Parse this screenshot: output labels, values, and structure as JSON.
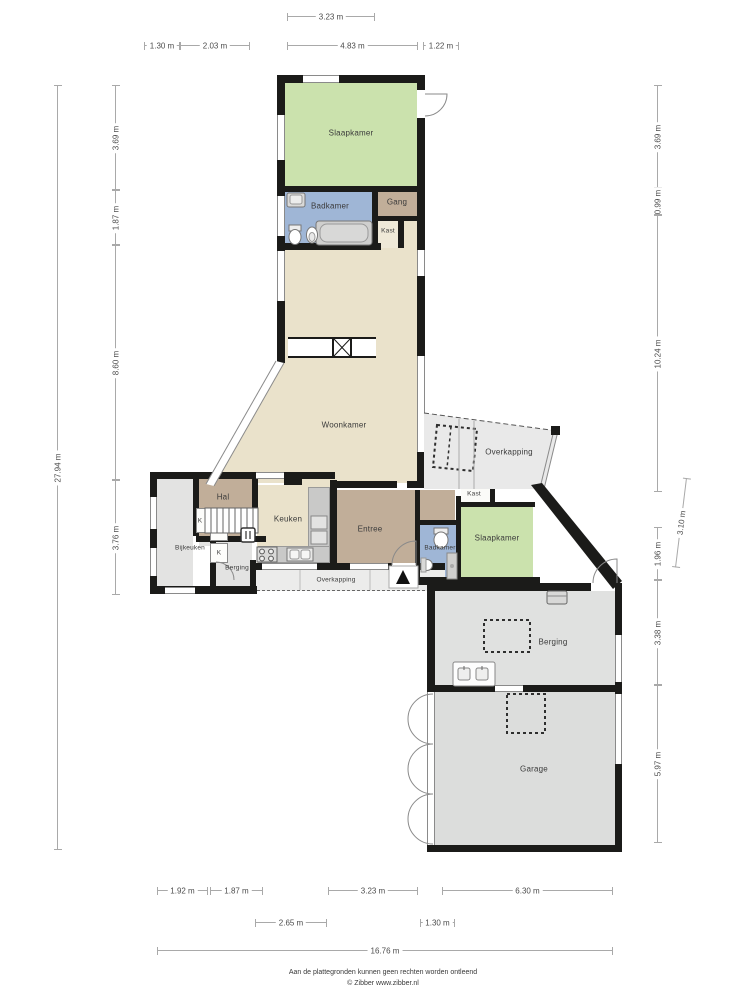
{
  "rooms": {
    "slaapkamer_top": "Slaapkamer",
    "badkamer_top": "Badkamer",
    "gang": "Gang",
    "kast_top": "Kast",
    "woonkamer": "Woonkamer",
    "overkapping_right": "Overkapping",
    "hal": "Hal",
    "keuken": "Keuken",
    "bijkeuken": "Bijkeuken",
    "berging_left": "Berging",
    "kast_k_stairs": "K",
    "kast_k_berging": "K",
    "entree": "Entree",
    "kast_mid": "Kast",
    "badkamer_mid": "Badkamer",
    "slaapkamer_mid": "Slaapkamer",
    "overkapping_bottom": "Overkapping",
    "berging_right": "Berging",
    "garage": "Garage"
  },
  "dimensions": {
    "top": {
      "w323": "3.23 m",
      "w130": "1.30 m",
      "w203": "2.03 m",
      "w483": "4.83 m",
      "w122": "1.22 m"
    },
    "left": {
      "h369": "3.69 m",
      "h187": "1.87 m",
      "h860": "8.60 m",
      "h376": "3.76 m",
      "total": "27.94 m"
    },
    "right": {
      "h369": "3.69 m",
      "h099": "0.99 m",
      "h1024": "10.24 m",
      "h310": "3.10 m",
      "h196": "1.96 m",
      "h338": "3.38 m",
      "h597": "5.97 m"
    },
    "bottom": {
      "w192": "1.92 m",
      "w187": "1.87 m",
      "w323": "3.23 m",
      "w630": "6.30 m",
      "w265": "2.65 m",
      "w130": "1.30 m",
      "total": "16.76 m"
    }
  },
  "colors": {
    "bedroom_green": "#cbe2ad",
    "bathroom_blue": "#9fb6d6",
    "living_beige": "#eae2cb",
    "hall_taupe": "#c1ae99",
    "utility_gray": "#e3e3e2",
    "garage_gray": "#dcdddc",
    "canopy_gray": "#e9e9e9",
    "wall_black": "#1b1b19"
  },
  "footer": {
    "line1": "Aan de plattegronden kunnen geen rechten worden ontleend",
    "line2": "© Zibber www.zibber.nl"
  }
}
